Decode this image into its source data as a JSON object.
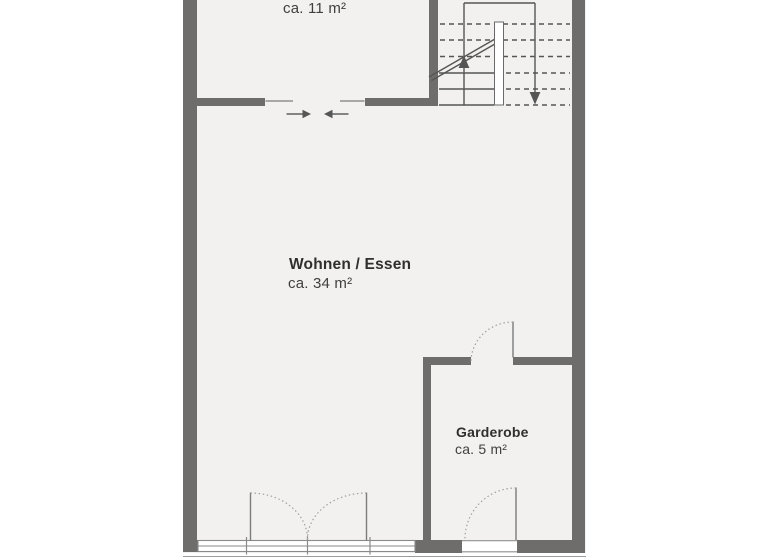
{
  "plan": {
    "rooms": {
      "top": {
        "area": "ca. 11 m²"
      },
      "living": {
        "name": "Wohnen / Essen",
        "area": "ca. 34 m²"
      },
      "garderobe": {
        "name": "Garderobe",
        "area": "ca. 5 m²"
      }
    },
    "colors": {
      "wall": "#6f6c6c",
      "floor": "#f2f1ef",
      "stair_line": "#555555",
      "thin_line": "#8f8f8f",
      "text": "#3a3a3a"
    }
  }
}
